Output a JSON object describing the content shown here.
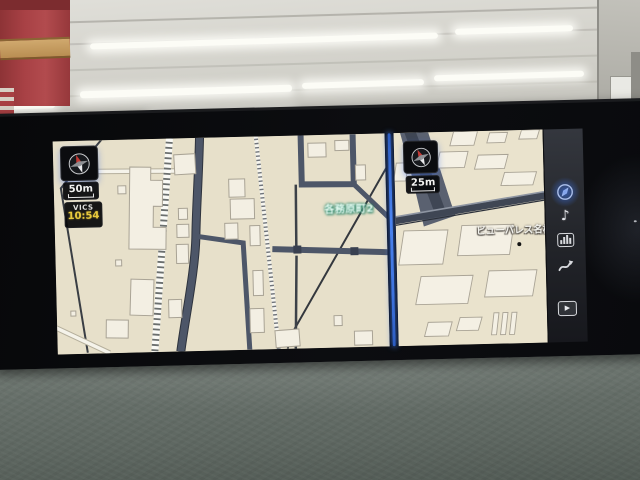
{
  "nav_display": {
    "left_map": {
      "scale_label": "50m",
      "vics_label": "VICS",
      "vics_time": "10:54",
      "intersection_label": "各務原町2",
      "compass_icon": "compass-rose-north-up"
    },
    "right_map": {
      "scale_label": "25m",
      "poi_label": "ビューパレス名柄",
      "compass_icon": "compass-rose-north-up"
    },
    "sidebar": {
      "icons": [
        {
          "name": "nav-compass-icon",
          "active": true
        },
        {
          "name": "music-note-icon",
          "glyph": "♪"
        },
        {
          "name": "audio-levels-icon"
        },
        {
          "name": "route-icon"
        },
        {
          "name": "video-icon",
          "glyph": "▶"
        }
      ]
    },
    "colors": {
      "map_background": "#e7e0ca",
      "road_dark": "#4d5668",
      "building_fill": "#f3efe3",
      "divider_glow": "#4a83ef",
      "vics_time_color": "#e8c93c",
      "compass_north": "#c43a35"
    }
  }
}
